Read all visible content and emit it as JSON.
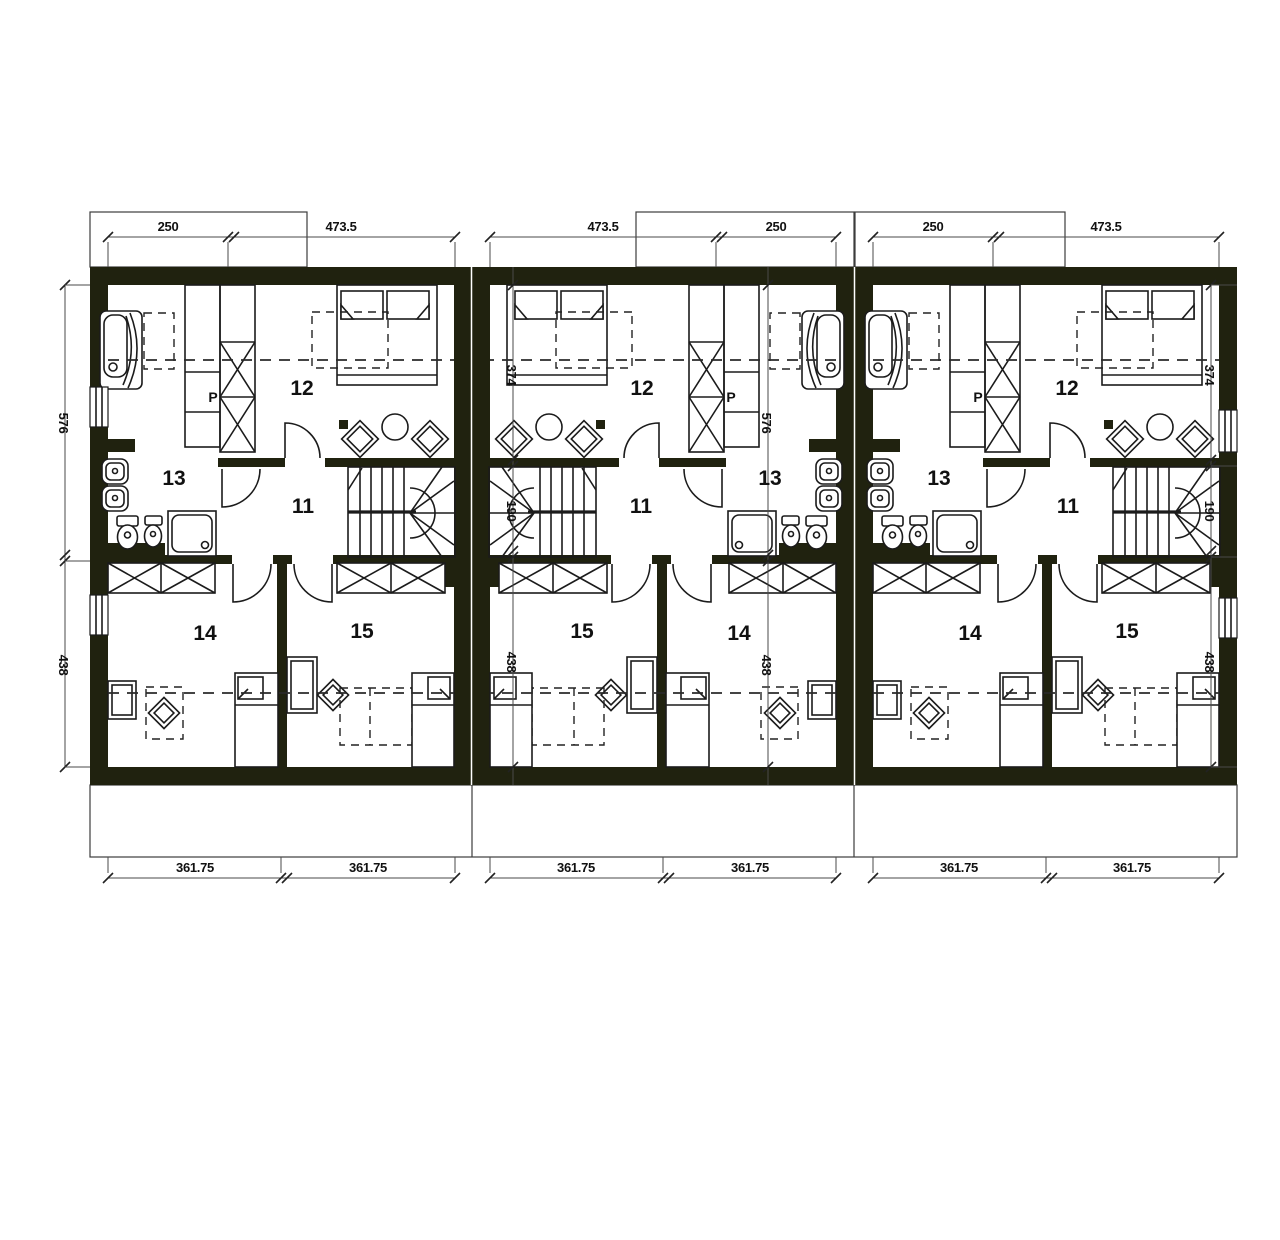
{
  "plan": {
    "type": "floor-plan",
    "rooms": {
      "hall": "11",
      "bedroom_top": "12",
      "bathroom": "13",
      "room_left": "14",
      "room_right": "15",
      "closet": "P"
    },
    "dims": {
      "top": [
        "250",
        "473.5",
        "473.5",
        "250",
        "250",
        "473.5"
      ],
      "bottom": [
        "361.75",
        "361.75",
        "361.75",
        "361.75",
        "361.75",
        "361.75"
      ],
      "left": [
        "576",
        "438"
      ],
      "right": [
        "374",
        "190",
        "438"
      ],
      "inner_stair_line": [
        "374",
        "190",
        "438"
      ],
      "inner_bath_line": [
        "576",
        "438"
      ]
    },
    "colors": {
      "wall": "#20220f",
      "line": "#1b1b1b",
      "dim_line": "#4a4a4a",
      "text": "#111111",
      "background": "#ffffff"
    }
  }
}
